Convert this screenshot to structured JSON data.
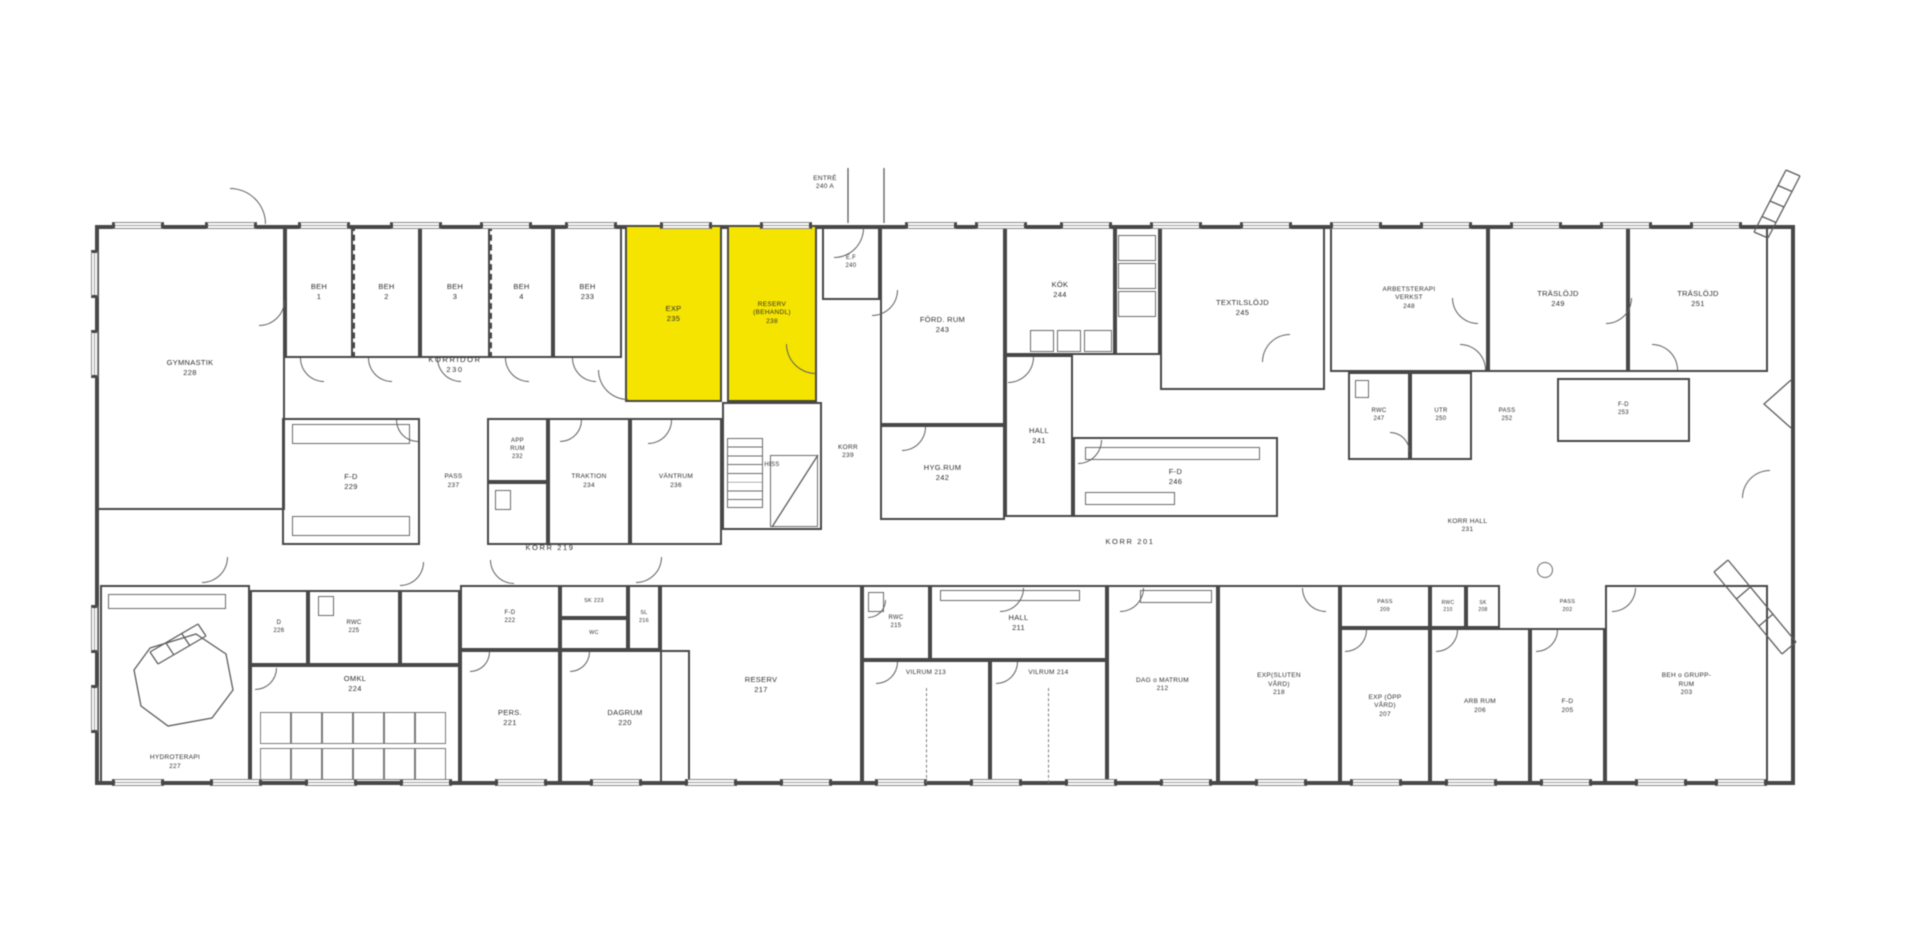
{
  "title": "Floor plan - rehabilitation ward (plan 2)",
  "colors": {
    "highlight": "#F5E400",
    "wall": "#474747",
    "line": "#5c5c5c",
    "text": "#2f2f2f"
  },
  "annotations": {
    "entrance_label": "ENTRÉ 240 A"
  },
  "highlighted_rooms": [
    "EXP 235",
    "RESERV (BEHANDL) 238"
  ],
  "rooms": [
    {
      "n": "gymnastik-228",
      "l": [
        "GYMNASTIK",
        "228"
      ],
      "x": 95,
      "y": 225,
      "w": 190,
      "h": 285
    },
    {
      "n": "beh-1",
      "l": [
        "BEH",
        "1"
      ],
      "x": 285,
      "y": 225,
      "w": 68,
      "h": 133
    },
    {
      "n": "beh-2",
      "l": [
        "BEH",
        "2"
      ],
      "x": 353,
      "y": 225,
      "w": 67,
      "h": 133,
      "dashed": [
        "left"
      ]
    },
    {
      "n": "beh-3",
      "l": [
        "BEH",
        "3"
      ],
      "x": 420,
      "y": 225,
      "w": 70,
      "h": 133
    },
    {
      "n": "beh-4",
      "l": [
        "BEH",
        "4"
      ],
      "x": 490,
      "y": 225,
      "w": 63,
      "h": 133,
      "dashed": [
        "left"
      ]
    },
    {
      "n": "beh-233",
      "l": [
        "BEH",
        "233"
      ],
      "x": 553,
      "y": 225,
      "w": 69,
      "h": 133
    },
    {
      "n": "korridor-230",
      "l": [
        "KORRIDOR",
        "230"
      ],
      "x": 400,
      "y": 348,
      "w": 110,
      "h": 34,
      "walls": false,
      "sp": true
    },
    {
      "n": "exp-235",
      "l": [
        "EXP",
        "235"
      ],
      "x": 625,
      "y": 225,
      "w": 97,
      "h": 177,
      "hl": true
    },
    {
      "n": "reserv-238",
      "l": [
        "RESERV",
        "(BEHANDL)",
        "238"
      ],
      "x": 727,
      "y": 225,
      "w": 90,
      "h": 177,
      "hl": true,
      "fs": 6.5
    },
    {
      "n": "ef-240",
      "l": [
        "E.F",
        "240"
      ],
      "x": 822,
      "y": 225,
      "w": 58,
      "h": 75,
      "fs": 6
    },
    {
      "n": "ford-rum-243",
      "l": [
        "FÖRD. RUM",
        "243"
      ],
      "x": 880,
      "y": 225,
      "w": 125,
      "h": 200
    },
    {
      "n": "kok-244",
      "l": [
        "KÖK",
        "244"
      ],
      "x": 1005,
      "y": 225,
      "w": 110,
      "h": 130
    },
    {
      "n": "pantry",
      "l": [],
      "x": 1115,
      "y": 225,
      "w": 45,
      "h": 130
    },
    {
      "n": "textilslojd-245",
      "l": [
        "TEXTILSLÖJD",
        "245"
      ],
      "x": 1160,
      "y": 225,
      "w": 165,
      "h": 165
    },
    {
      "n": "hall-241",
      "l": [
        "HALL",
        "241"
      ],
      "x": 1005,
      "y": 355,
      "w": 68,
      "h": 162
    },
    {
      "n": "hyg-rum-242",
      "l": [
        "HYG.RUM",
        "242"
      ],
      "x": 880,
      "y": 425,
      "w": 125,
      "h": 95
    },
    {
      "n": "fd-246",
      "l": [
        "F-D",
        "246"
      ],
      "x": 1073,
      "y": 437,
      "w": 205,
      "h": 80
    },
    {
      "n": "trapphus-hiss",
      "l": [
        "HISS"
      ],
      "x": 722,
      "y": 402,
      "w": 100,
      "h": 128,
      "fs": 6
    },
    {
      "n": "korr-239",
      "l": [
        "KORR",
        "239"
      ],
      "x": 822,
      "y": 436,
      "w": 52,
      "h": 32,
      "walls": false,
      "fs": 6.5
    },
    {
      "n": "pass-237",
      "l": [
        "PASS",
        "237"
      ],
      "x": 420,
      "y": 418,
      "w": 67,
      "h": 127,
      "walls": false,
      "fs": 6.5
    },
    {
      "n": "app-rum-232",
      "l": [
        "APP",
        "RUM",
        "232"
      ],
      "x": 487,
      "y": 418,
      "w": 61,
      "h": 64,
      "fs": 6
    },
    {
      "n": "wc-under-app",
      "l": [],
      "x": 487,
      "y": 482,
      "w": 61,
      "h": 63
    },
    {
      "n": "traktion-234",
      "l": [
        "TRAKTION",
        "234"
      ],
      "x": 548,
      "y": 418,
      "w": 82,
      "h": 127,
      "fs": 6.5
    },
    {
      "n": "vantrum-236",
      "l": [
        "VÄNTRUM",
        "236"
      ],
      "x": 630,
      "y": 418,
      "w": 92,
      "h": 127,
      "fs": 6.5
    },
    {
      "n": "fd-229",
      "l": [
        "F-D",
        "229"
      ],
      "x": 282,
      "y": 418,
      "w": 138,
      "h": 127
    },
    {
      "n": "hydroterapi-227",
      "l": [
        "HYDROTERAPI",
        "227"
      ],
      "x": 100,
      "y": 585,
      "w": 150,
      "h": 200,
      "align": "bottom",
      "fs": 6.5
    },
    {
      "n": "d-226",
      "l": [
        "D",
        "226"
      ],
      "x": 250,
      "y": 590,
      "w": 58,
      "h": 75,
      "fs": 6
    },
    {
      "n": "rwc-225",
      "l": [
        "RWC",
        "225"
      ],
      "x": 308,
      "y": 590,
      "w": 92,
      "h": 75,
      "fs": 6
    },
    {
      "n": "lobby-omkl",
      "l": [],
      "x": 400,
      "y": 590,
      "w": 60,
      "h": 75
    },
    {
      "n": "omkl-224",
      "l": [
        "OMKL",
        "224"
      ],
      "x": 250,
      "y": 665,
      "w": 210,
      "h": 120,
      "align": "top"
    },
    {
      "n": "fd-222",
      "l": [
        "F-D",
        "222"
      ],
      "x": 460,
      "y": 585,
      "w": 100,
      "h": 65,
      "fs": 6
    },
    {
      "n": "sk-223",
      "l": [
        "SK 223"
      ],
      "x": 560,
      "y": 585,
      "w": 68,
      "h": 33,
      "fs": 5.5
    },
    {
      "n": "wc-223",
      "l": [
        "WC"
      ],
      "x": 560,
      "y": 618,
      "w": 68,
      "h": 32,
      "fs": 5.5
    },
    {
      "n": "sl-216",
      "l": [
        "SL",
        "216"
      ],
      "x": 628,
      "y": 585,
      "w": 32,
      "h": 65,
      "fs": 5.5
    },
    {
      "n": "pers-221",
      "l": [
        "PERS.",
        "221"
      ],
      "x": 460,
      "y": 650,
      "w": 100,
      "h": 135
    },
    {
      "n": "dagrum-220",
      "l": [
        "DAGRUM",
        "220"
      ],
      "x": 560,
      "y": 650,
      "w": 130,
      "h": 135
    },
    {
      "n": "reserv-217",
      "l": [
        "RESERV",
        "217"
      ],
      "x": 660,
      "y": 585,
      "w": 202,
      "h": 200
    },
    {
      "n": "rwc-215",
      "l": [
        "RWC",
        "215"
      ],
      "x": 862,
      "y": 585,
      "w": 68,
      "h": 75,
      "fs": 6
    },
    {
      "n": "hall-211",
      "l": [
        "HALL",
        "211"
      ],
      "x": 930,
      "y": 585,
      "w": 177,
      "h": 75
    },
    {
      "n": "vilrum-213",
      "l": [
        "VILRUM 213"
      ],
      "x": 862,
      "y": 660,
      "w": 128,
      "h": 125,
      "align": "top",
      "fs": 6.5
    },
    {
      "n": "vilrum-214",
      "l": [
        "VILRUM 214"
      ],
      "x": 990,
      "y": 660,
      "w": 117,
      "h": 125,
      "align": "top",
      "fs": 6.5
    },
    {
      "n": "dag-o-matrum-212",
      "l": [
        "DAG o MATRUM",
        "212"
      ],
      "x": 1107,
      "y": 585,
      "w": 111,
      "h": 200,
      "fs": 6.5
    },
    {
      "n": "exp-sluten-vard-218",
      "l": [
        "EXP(SLUTEN",
        "VÅRD)",
        "218"
      ],
      "x": 1218,
      "y": 585,
      "w": 122,
      "h": 200,
      "fs": 6.5
    },
    {
      "n": "pass-209",
      "l": [
        "PASS",
        "209"
      ],
      "x": 1340,
      "y": 585,
      "w": 90,
      "h": 43,
      "fs": 5.5
    },
    {
      "n": "exp-opp-vard-207",
      "l": [
        "EXP (ÖPP",
        "VÅRD)",
        "207"
      ],
      "x": 1340,
      "y": 628,
      "w": 90,
      "h": 157,
      "fs": 6.5
    },
    {
      "n": "rwc-210",
      "l": [
        "RWC",
        "210"
      ],
      "x": 1430,
      "y": 585,
      "w": 36,
      "h": 43,
      "fs": 5
    },
    {
      "n": "sk-208",
      "l": [
        "SK",
        "208"
      ],
      "x": 1466,
      "y": 585,
      "w": 34,
      "h": 43,
      "fs": 5
    },
    {
      "n": "arb-rum-206",
      "l": [
        "ARB RUM",
        "206"
      ],
      "x": 1430,
      "y": 628,
      "w": 100,
      "h": 157,
      "fs": 6.5
    },
    {
      "n": "pass-202",
      "l": [
        "PASS",
        "202"
      ],
      "x": 1530,
      "y": 585,
      "w": 75,
      "h": 43,
      "walls": false,
      "fs": 5.5
    },
    {
      "n": "fd-205",
      "l": [
        "F-D",
        "205"
      ],
      "x": 1530,
      "y": 628,
      "w": 75,
      "h": 157,
      "fs": 6.5
    },
    {
      "n": "beh-o-grupprum-203",
      "l": [
        "BEH o GRUPP-",
        "RUM",
        "203"
      ],
      "x": 1605,
      "y": 585,
      "w": 163,
      "h": 200,
      "fs": 6.5
    },
    {
      "n": "korr-219",
      "l": [
        "KORR  219"
      ],
      "x": 495,
      "y": 538,
      "w": 110,
      "h": 20,
      "walls": false,
      "sp": true
    },
    {
      "n": "korr-201",
      "l": [
        "KORR  201"
      ],
      "x": 1080,
      "y": 532,
      "w": 100,
      "h": 20,
      "walls": false,
      "sp": true
    },
    {
      "n": "korr-hall-231",
      "l": [
        "KORR HALL",
        "231"
      ],
      "x": 1420,
      "y": 510,
      "w": 95,
      "h": 32,
      "walls": false,
      "fs": 6.5
    },
    {
      "n": "arbetsterapi-248",
      "l": [
        "ARBETSTERAPI",
        "VERKST",
        "248"
      ],
      "x": 1330,
      "y": 225,
      "w": 158,
      "h": 147,
      "fs": 6.5
    },
    {
      "n": "traslojd-249",
      "l": [
        "TRÄSLÖJD",
        "249"
      ],
      "x": 1488,
      "y": 225,
      "w": 140,
      "h": 147
    },
    {
      "n": "traslojd-251",
      "l": [
        "TRÄSLÖJD",
        "251"
      ],
      "x": 1628,
      "y": 225,
      "w": 140,
      "h": 147
    },
    {
      "n": "rwc-247",
      "l": [
        "RWC",
        "247"
      ],
      "x": 1348,
      "y": 372,
      "w": 62,
      "h": 88,
      "fs": 6
    },
    {
      "n": "utr-250",
      "l": [
        "UTR",
        "250"
      ],
      "x": 1410,
      "y": 372,
      "w": 62,
      "h": 88,
      "fs": 6
    },
    {
      "n": "pass-252",
      "l": [
        "PASS",
        "252"
      ],
      "x": 1472,
      "y": 372,
      "w": 70,
      "h": 88,
      "walls": false,
      "fs": 6
    },
    {
      "n": "fd-253",
      "l": [
        "F-D",
        "253"
      ],
      "x": 1557,
      "y": 378,
      "w": 133,
      "h": 64,
      "fs": 6
    },
    {
      "n": "entre-240a",
      "l": [
        "ENTRÉ",
        "240 A"
      ],
      "x": 790,
      "y": 168,
      "w": 70,
      "h": 30,
      "walls": false,
      "fs": 6.5
    }
  ],
  "envelope": {
    "x": 95,
    "y": 225,
    "w": 1700,
    "h": 560
  },
  "doors": [
    {
      "x": 230,
      "y": 188,
      "r": 36,
      "q": "tr"
    },
    {
      "x": 259,
      "y": 300,
      "r": 26,
      "q": "br"
    },
    {
      "x": 300,
      "y": 358,
      "r": 24,
      "q": "bl"
    },
    {
      "x": 368,
      "y": 358,
      "r": 24,
      "q": "bl"
    },
    {
      "x": 437,
      "y": 358,
      "r": 24,
      "q": "bl"
    },
    {
      "x": 505,
      "y": 358,
      "r": 24,
      "q": "bl"
    },
    {
      "x": 572,
      "y": 358,
      "r": 24,
      "q": "bl"
    },
    {
      "x": 598,
      "y": 370,
      "r": 30,
      "q": "bl"
    },
    {
      "x": 786,
      "y": 344,
      "r": 30,
      "q": "bl"
    },
    {
      "x": 834,
      "y": 228,
      "r": 30,
      "q": "br"
    },
    {
      "x": 872,
      "y": 290,
      "r": 26,
      "q": "br"
    },
    {
      "x": 1008,
      "y": 357,
      "r": 26,
      "q": "br"
    },
    {
      "x": 902,
      "y": 427,
      "r": 24,
      "q": "br"
    },
    {
      "x": 1078,
      "y": 440,
      "r": 24,
      "q": "br"
    },
    {
      "x": 1262,
      "y": 334,
      "r": 28,
      "q": "tl"
    },
    {
      "x": 1452,
      "y": 298,
      "r": 26,
      "q": "bl"
    },
    {
      "x": 1460,
      "y": 344,
      "r": 26,
      "q": "tr"
    },
    {
      "x": 1606,
      "y": 298,
      "r": 26,
      "q": "br"
    },
    {
      "x": 1652,
      "y": 344,
      "r": 26,
      "q": "tr"
    },
    {
      "x": 1390,
      "y": 432,
      "r": 20,
      "q": "tr"
    },
    {
      "x": 648,
      "y": 420,
      "r": 24,
      "q": "br"
    },
    {
      "x": 560,
      "y": 420,
      "r": 22,
      "q": "br"
    },
    {
      "x": 396,
      "y": 420,
      "r": 22,
      "q": "bl"
    },
    {
      "x": 202,
      "y": 557,
      "r": 26,
      "q": "br"
    },
    {
      "x": 400,
      "y": 562,
      "r": 24,
      "q": "br"
    },
    {
      "x": 490,
      "y": 560,
      "r": 24,
      "q": "bl"
    },
    {
      "x": 636,
      "y": 557,
      "r": 26,
      "q": "br"
    },
    {
      "x": 1000,
      "y": 588,
      "r": 24,
      "q": "br"
    },
    {
      "x": 868,
      "y": 600,
      "r": 18,
      "q": "br"
    },
    {
      "x": 876,
      "y": 662,
      "r": 22,
      "q": "br"
    },
    {
      "x": 996,
      "y": 662,
      "r": 22,
      "q": "br"
    },
    {
      "x": 1120,
      "y": 588,
      "r": 24,
      "q": "br"
    },
    {
      "x": 1302,
      "y": 588,
      "r": 24,
      "q": "bl"
    },
    {
      "x": 1345,
      "y": 630,
      "r": 22,
      "q": "br"
    },
    {
      "x": 1436,
      "y": 630,
      "r": 22,
      "q": "br"
    },
    {
      "x": 1536,
      "y": 630,
      "r": 22,
      "q": "br"
    },
    {
      "x": 1612,
      "y": 588,
      "r": 24,
      "q": "br"
    },
    {
      "x": 1742,
      "y": 470,
      "r": 28,
      "q": "tl"
    },
    {
      "x": 255,
      "y": 668,
      "r": 22,
      "q": "br"
    },
    {
      "x": 470,
      "y": 652,
      "r": 20,
      "q": "br"
    },
    {
      "x": 570,
      "y": 652,
      "r": 20,
      "q": "br"
    }
  ],
  "windows": {
    "w": 52,
    "h": 48,
    "top_y": 222,
    "bottom_y": 779,
    "left_x": 91,
    "top": [
      112,
      205,
      298,
      390,
      480,
      565,
      660,
      760,
      905,
      975,
      1060,
      1150,
      1240,
      1330,
      1420,
      1510,
      1600,
      1690
    ],
    "bottom": [
      112,
      210,
      305,
      400,
      495,
      590,
      685,
      780,
      875,
      970,
      1065,
      1160,
      1255,
      1350,
      1445,
      1540,
      1635,
      1715
    ],
    "left": [
      250,
      330,
      605,
      685
    ]
  },
  "fixtures": [
    {
      "t": "stairs",
      "x": 727,
      "y": 438,
      "w": 36,
      "h": 70,
      "n": 8
    },
    {
      "t": "rect",
      "x": 770,
      "y": 455,
      "w": 48,
      "h": 72
    },
    {
      "t": "rect",
      "x": 292,
      "y": 424,
      "w": 118,
      "h": 20
    },
    {
      "t": "rect",
      "x": 292,
      "y": 516,
      "w": 118,
      "h": 20
    },
    {
      "t": "rect",
      "x": 1030,
      "y": 330,
      "w": 24,
      "h": 22
    },
    {
      "t": "rect",
      "x": 1057,
      "y": 330,
      "w": 24,
      "h": 22
    },
    {
      "t": "rect",
      "x": 1084,
      "y": 330,
      "w": 28,
      "h": 22
    },
    {
      "t": "rect",
      "x": 1118,
      "y": 235,
      "w": 38,
      "h": 26
    },
    {
      "t": "rect",
      "x": 1118,
      "y": 263,
      "w": 38,
      "h": 26
    },
    {
      "t": "rect",
      "x": 1118,
      "y": 291,
      "w": 38,
      "h": 26
    },
    {
      "t": "rect",
      "x": 1085,
      "y": 447,
      "w": 175,
      "h": 13
    },
    {
      "t": "rect",
      "x": 1085,
      "y": 492,
      "w": 90,
      "h": 13
    },
    {
      "t": "stalls",
      "x": 260,
      "y": 712,
      "w": 186,
      "h": 32,
      "n": 6
    },
    {
      "t": "stalls",
      "x": 260,
      "y": 748,
      "w": 186,
      "h": 32,
      "n": 6
    },
    {
      "t": "rect",
      "x": 108,
      "y": 594,
      "w": 118,
      "h": 15
    },
    {
      "t": "rect",
      "x": 940,
      "y": 590,
      "w": 140,
      "h": 11
    },
    {
      "t": "rect",
      "x": 1140,
      "y": 590,
      "w": 72,
      "h": 13
    },
    {
      "t": "rect",
      "x": 318,
      "y": 596,
      "w": 16,
      "h": 20
    },
    {
      "t": "rect",
      "x": 868,
      "y": 592,
      "w": 16,
      "h": 20
    },
    {
      "t": "rect",
      "x": 1355,
      "y": 380,
      "w": 14,
      "h": 18
    },
    {
      "t": "rect",
      "x": 495,
      "y": 490,
      "w": 16,
      "h": 20
    },
    {
      "t": "dashv",
      "x": 926,
      "y": 688,
      "h": 95
    },
    {
      "t": "dashv",
      "x": 1048,
      "y": 688,
      "h": 95
    },
    {
      "t": "circle",
      "x": 1545,
      "y": 570,
      "r": 8
    }
  ]
}
